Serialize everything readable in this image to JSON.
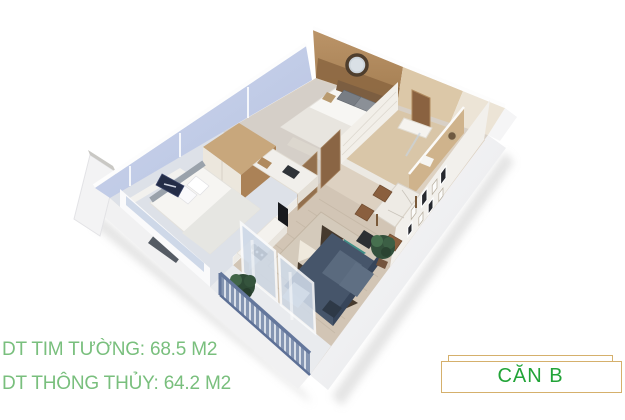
{
  "render": {
    "alt": "3D isometric cutaway render of apartment unit",
    "colors": {
      "wood_wall": "#b48d60",
      "bathroom_wall": "#dcc8a8",
      "window_wall": "#c2cde6",
      "living_floor": "#d2c5b5",
      "bedroom2_floor": "#dde1e8",
      "sofa": "#46556a",
      "rug_accent": "#3f8d86",
      "balcony_railing": "#8495b2",
      "plant": "#2e4a36",
      "exterior_wall": "#f1f1f2"
    }
  },
  "areas": {
    "gross": {
      "text": "DT TIM TƯỜNG: 68.5 M2"
    },
    "net": {
      "text": "DT THÔNG THỦY: 64.2 M2"
    },
    "text_color": "#79bf7d"
  },
  "badge": {
    "label": "CĂN B",
    "text_color": "#22a438",
    "border_color": "#d5b06c"
  }
}
